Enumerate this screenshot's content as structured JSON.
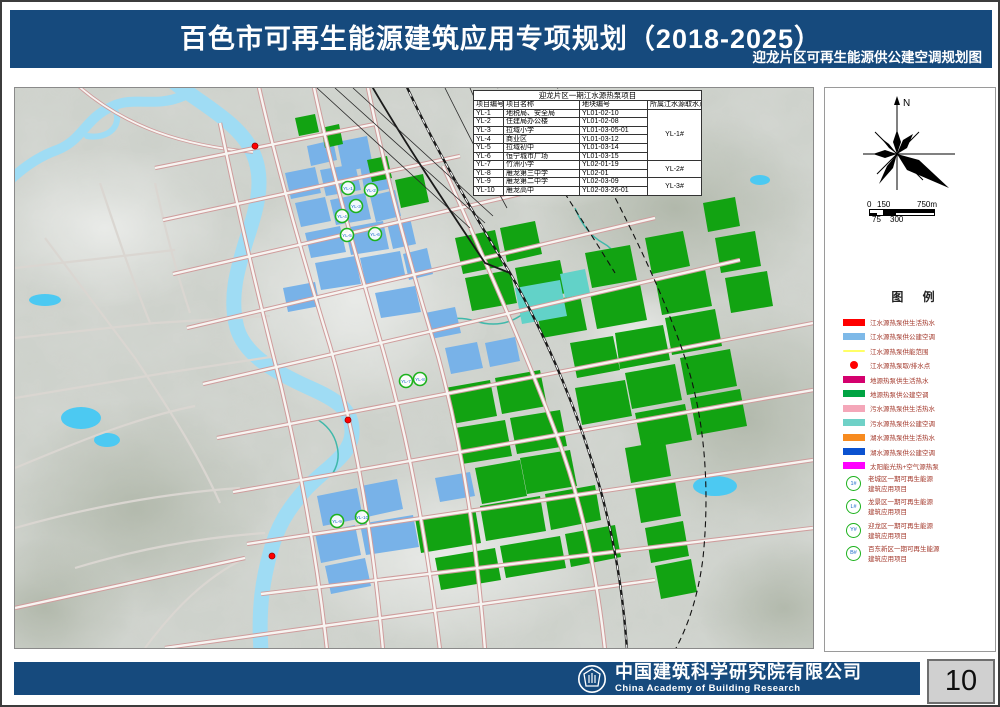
{
  "header": {
    "title": "百色市可再生能源建筑应用专项规划（2018-2025）",
    "subtitle": "迎龙片区可再生能源供公建空调规划图",
    "band_color": "#164a7d"
  },
  "map": {
    "table": {
      "title": "迎龙片区一期江水源热泵项目",
      "columns": [
        "项目编号",
        "项目名称",
        "地块编号",
        "所属江水源取水点"
      ],
      "rows": [
        [
          "YL-1",
          "地税局、安全局",
          "YL01-02-10"
        ],
        [
          "YL-2",
          "住建局办公楼",
          "YL01-02-08"
        ],
        [
          "YL-3",
          "拉域小学",
          "YL01-03-05-01"
        ],
        [
          "YL-4",
          "商业区",
          "YL01-03-12"
        ],
        [
          "YL-5",
          "拉域初中",
          "YL01-03-14"
        ],
        [
          "YL-6",
          "恒宁城市广场",
          "YL01-03-15"
        ],
        [
          "YL-7",
          "竹洲小学",
          "YL02-01-19"
        ],
        [
          "YL-8",
          "雁龙第三中学",
          "YL02-01"
        ],
        [
          "YL-9",
          "雁龙第二中学",
          "YL02-03-09"
        ],
        [
          "YL-10",
          "雁龙高中",
          "YL02-03-26-01"
        ]
      ],
      "intake_groups": [
        {
          "label": "YL-1#",
          "start": 0,
          "span": 6
        },
        {
          "label": "YL-2#",
          "start": 6,
          "span": 2
        },
        {
          "label": "YL-3#",
          "start": 8,
          "span": 2
        }
      ]
    },
    "markers": {
      "labels": [
        "YL-1",
        "YL-2",
        "YL-3",
        "YL-4",
        "YL-5",
        "YL-6",
        "YL-7",
        "YL-8",
        "YL-9",
        "YL-10"
      ]
    },
    "colors": {
      "river": "#9fdcf4",
      "lake": "#4cc9f2",
      "parcel_river_hvac_blue": "#78b2e8",
      "parcel_ground_hvac_green": "#12a312",
      "parcel_sewage_hvac_cyan": "#62d2c8",
      "marker_ring_green": "#1db21d",
      "intake_point_red": "#ff0000"
    }
  },
  "panel": {
    "north_label": "N",
    "scale": {
      "top_labels": [
        "0",
        "150",
        "750m"
      ],
      "bottom_labels": [
        "75",
        "300"
      ]
    },
    "legend": {
      "title": "图 例",
      "items": [
        {
          "type": "bar",
          "color": "#ff0000",
          "label": "江水源热泵供生活热水"
        },
        {
          "type": "bar",
          "color": "#7eb9e8",
          "label": "江水源热泵供公建空调"
        },
        {
          "type": "line",
          "color": "#ffff66",
          "label": "江水源热泵供能范围"
        },
        {
          "type": "dot",
          "color": "#ff0000",
          "label": "江水源热泵取/排水点"
        },
        {
          "type": "bar",
          "color": "#d4006e",
          "label": "地源热泵供生活热水"
        },
        {
          "type": "bar",
          "color": "#00a443",
          "label": "地源热泵供公建空调"
        },
        {
          "type": "bar",
          "color": "#f4a7b9",
          "label": "污水源热泵供生活热水"
        },
        {
          "type": "bar",
          "color": "#6fd1c7",
          "label": "污水源热泵供公建空调"
        },
        {
          "type": "bar",
          "color": "#f78b1f",
          "label": "湖水源热泵供生活热水"
        },
        {
          "type": "bar",
          "color": "#0b52d0",
          "label": "湖水源热泵供公建空调"
        },
        {
          "type": "bar",
          "color": "#ff00ff",
          "label": "太阳能光热+空气源热泵"
        }
      ],
      "projects": [
        {
          "badge": "1#",
          "line1": "老城区一期可再生能源",
          "line2": "建筑应用项目"
        },
        {
          "badge": "L#",
          "line1": "龙景区一期可再生能源",
          "line2": "建筑应用项目"
        },
        {
          "badge": "Y#",
          "line1": "迎龙区一期可再生能源",
          "line2": "建筑应用项目"
        },
        {
          "badge": "B#",
          "line1": "百东新区一期可再生能源",
          "line2": "建筑应用项目"
        }
      ]
    }
  },
  "footer": {
    "company_cn": "中国建筑科学研究院有限公司",
    "company_en": "China Academy of Building Research",
    "page_number": "10"
  }
}
